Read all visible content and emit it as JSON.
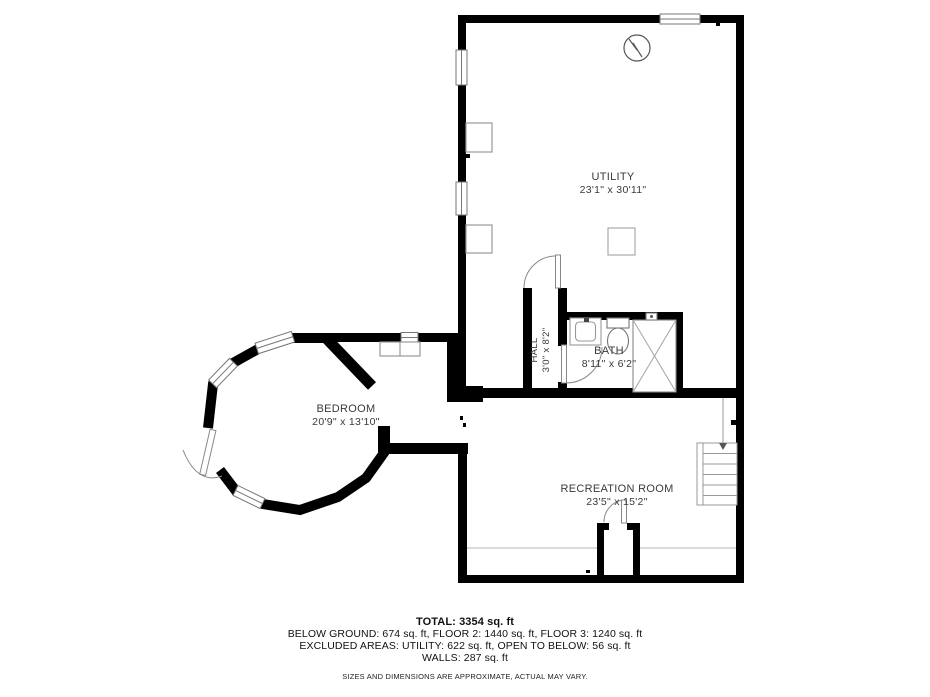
{
  "rooms": [
    {
      "name": "UTILITY",
      "dims": "23'1\" x 30'11\""
    },
    {
      "name": "HALL",
      "dims": "3'0\" x 8'2\""
    },
    {
      "name": "BATH",
      "dims": "8'11\" x 6'2\""
    },
    {
      "name": "BEDROOM",
      "dims": "20'9\" x 13'10\""
    },
    {
      "name": "RECREATION ROOM",
      "dims": "23'5\" x 15'2\""
    }
  ],
  "summary": {
    "total": "TOTAL: 3354 sq. ft",
    "line1": "BELOW GROUND: 674 sq. ft, FLOOR 2: 1440 sq. ft, FLOOR 3: 1240 sq. ft",
    "line2": "EXCLUDED AREAS: UTILITY: 622 sq. ft, OPEN TO BELOW: 56 sq. ft",
    "line3": "WALLS: 287 sq. ft",
    "disclaimer": "SIZES AND DIMENSIONS ARE APPROXIMATE, ACTUAL MAY VARY."
  },
  "colors": {
    "wall": "#000000",
    "fixture_outline": "#999999",
    "door_arc": "#888888",
    "label_text": "#3a3a3a",
    "summary_text": "#111111"
  }
}
